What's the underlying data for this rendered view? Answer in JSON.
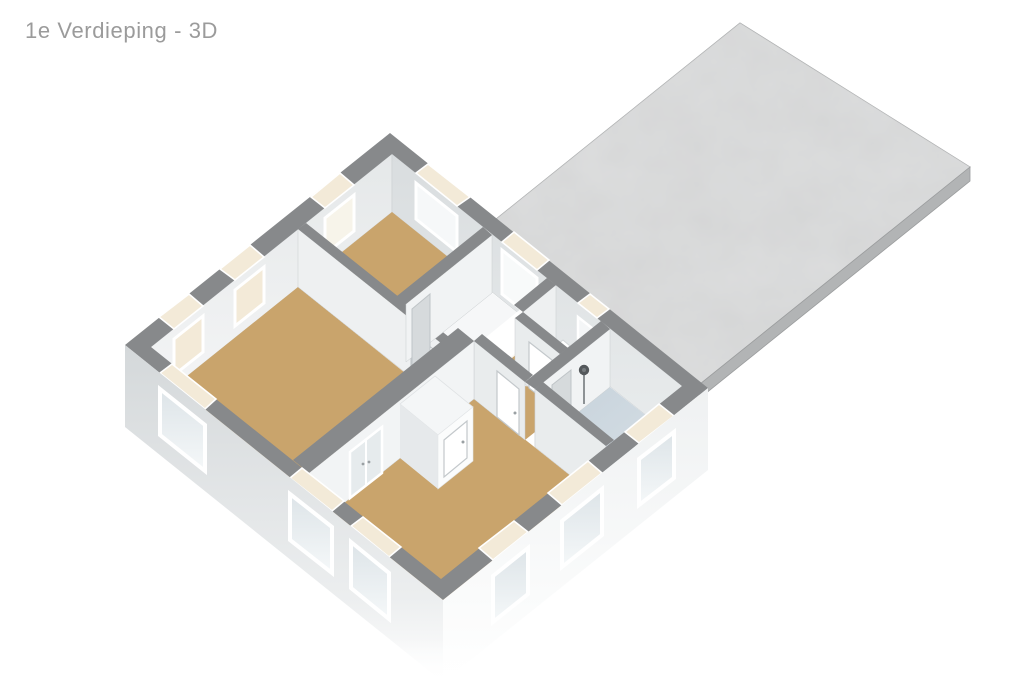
{
  "title": "1e Verdieping - 3D",
  "palette": {
    "background": "#ffffff",
    "title_color": "#9b9b9b",
    "floor": "#c9a46c",
    "bath_floor": "#ccd7df",
    "wall_top": "#87898b",
    "roof": "#c7c9ca",
    "roof_edge": "#b2b4b5",
    "exterior_shade": "#d6dadc",
    "exterior_light": "#f0f2f3",
    "interior_wall": "#eef0f1",
    "glass": "#e3e9ec",
    "sill": "#f3ead8"
  },
  "scene": {
    "view": "3d-isometric-floorplan",
    "rooms": [
      "bedroom-large",
      "bedroom-top",
      "bedroom-bottom",
      "landing",
      "toilet",
      "bathroom",
      "stairwell"
    ],
    "features": [
      "flat-roof-deck",
      "staircase",
      "banister",
      "shower",
      "wardrobe",
      "interior-doors"
    ],
    "window_count": 12
  }
}
